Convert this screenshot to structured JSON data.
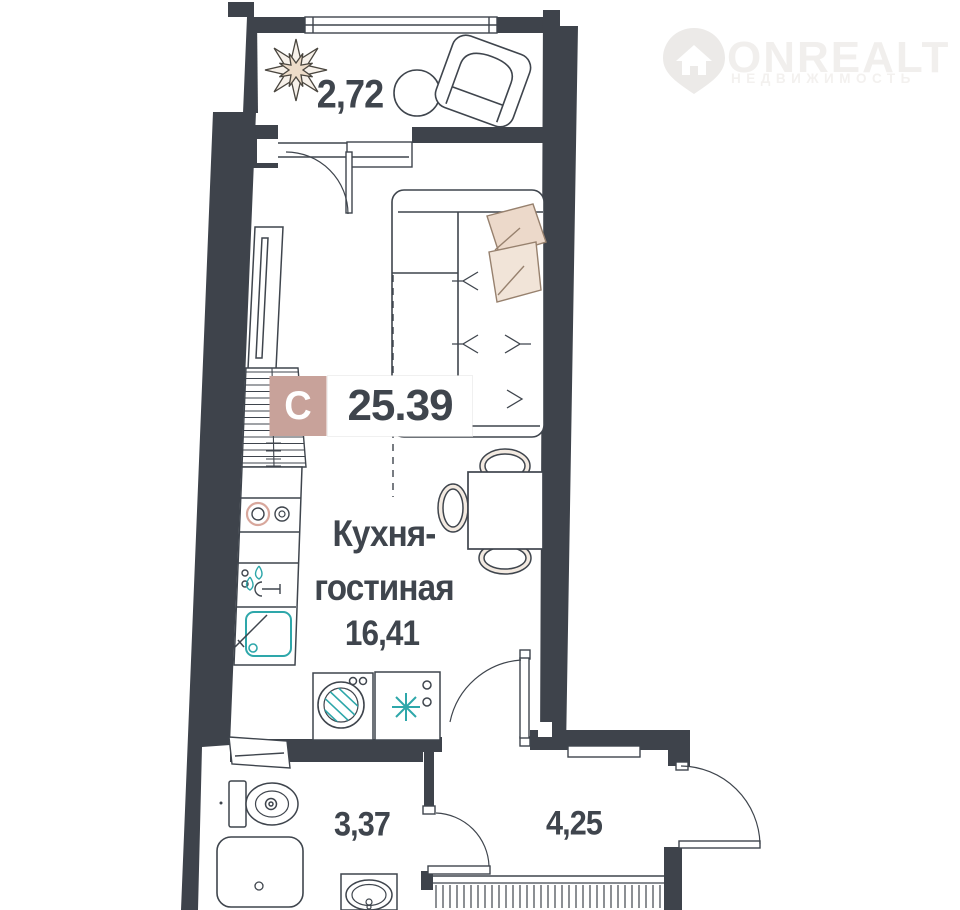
{
  "brand": {
    "name": "ONREALT",
    "tagline": "НЕДВИЖИМОСТЬ"
  },
  "badge": {
    "letter": "С",
    "total_area": "25.39"
  },
  "rooms": [
    {
      "id": "balcony",
      "area": "2,72"
    },
    {
      "id": "kitchen-living",
      "name_line1": "Кухня-",
      "name_line2": "гостиная",
      "area": "16,41"
    },
    {
      "id": "bathroom",
      "area": "3,37"
    },
    {
      "id": "hallway",
      "area": "4,25"
    }
  ],
  "colors": {
    "wall": "#3e434b",
    "line": "#3f454d",
    "accent_teal": "#2ea7aa",
    "badge_pink": "#c8a29a",
    "furniture_beige": "#ecd9ca",
    "watermark": "#f1efed"
  }
}
